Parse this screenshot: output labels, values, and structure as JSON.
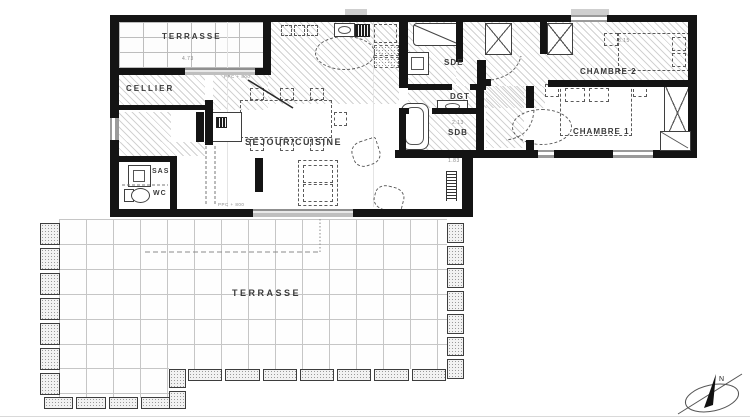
{
  "rooms": {
    "terrasse_top": {
      "label": "TERRASSE",
      "dim": "4.73"
    },
    "cellier": {
      "label": "CELLIER"
    },
    "sas": {
      "label": "SAS"
    },
    "wc": {
      "label": "WC"
    },
    "sejour_cuisine": {
      "label": "SEJOUR/CUISINE"
    },
    "sde": {
      "label": "SDE"
    },
    "dgt": {
      "label": "DGT"
    },
    "sdb": {
      "label": "SDB",
      "dim_width": "2.13",
      "dim_below": "1.83"
    },
    "chambre1": {
      "label": "CHAMBRE 1"
    },
    "chambre2": {
      "label": "CHAMBRE 2",
      "dim_bed": "3.15"
    },
    "terrasse_bottom": {
      "label": "TERRASSE"
    }
  },
  "annotations": {
    "door_note_top": "PPC + 800",
    "door_note_bottom": "PPC + 800",
    "compass_north": "N"
  },
  "colors": {
    "wall": "#141414",
    "hatch_line": "#d2d2d2",
    "tile_line": "#c6c6c6",
    "label_text": "#3a3a3a",
    "dim_text": "#8a8a8a",
    "window": "#9a9a9a",
    "furniture_dash": "#5a5a5a"
  }
}
